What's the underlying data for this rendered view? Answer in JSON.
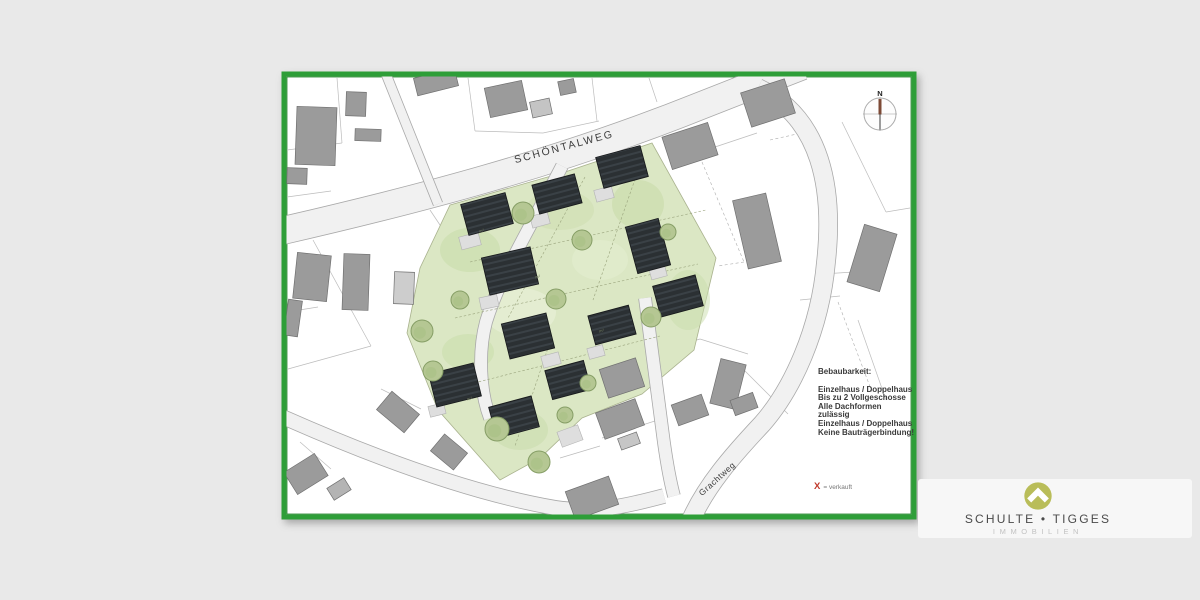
{
  "plan": {
    "streets": {
      "schoentalweg": "SCHÖNTALWEG",
      "grachtweg": "Grachtweg"
    },
    "compass_label": "N",
    "area_label": "m²",
    "legend": {
      "title": "Bebaubarkeit:",
      "lines": [
        "Einzelhaus / Doppelhaus",
        "Bis zu 2 Vollgeschosse",
        "Alle Dachformen zulässig",
        "Einzelhaus / Doppelhaus",
        "Keine Bauträgerbindung!"
      ]
    },
    "sold": {
      "symbol": "X",
      "label": "= verkauft"
    }
  },
  "logo": {
    "brand": "SCHULTE • TIGGES",
    "division": "IMMOBILIEN"
  },
  "colors": {
    "background": "#e9e9e9",
    "plan_border_green": "#2f9e38",
    "grass_green": "#dbe7c4",
    "new_roof_dark": "#2b3033",
    "existing_building_gray": "#9b9b9b",
    "road_gray": "#f1f1f1",
    "sold_red": "#c0392b",
    "logo_olive": "#b9bd59",
    "compass_needle_brown": "#7d4a36"
  }
}
